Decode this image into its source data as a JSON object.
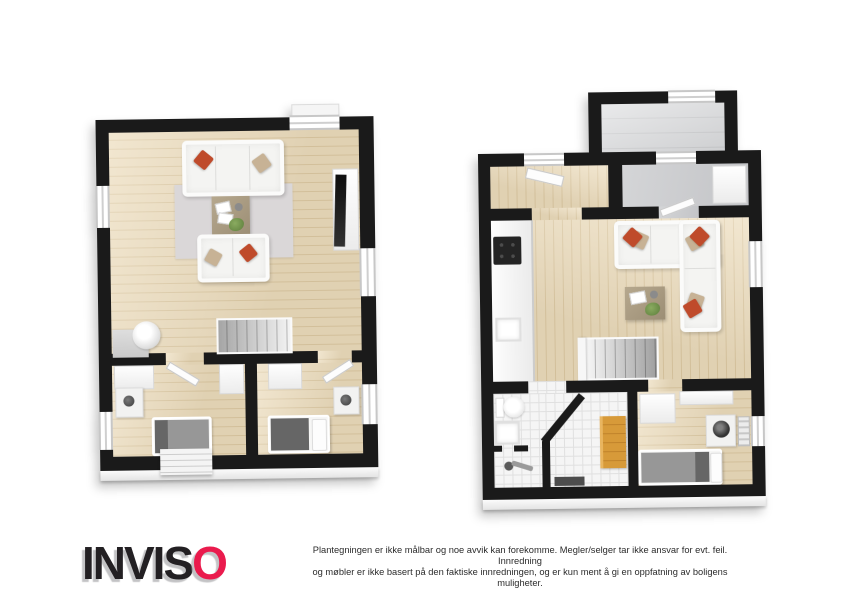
{
  "footer": {
    "brand": {
      "name": "INVISO",
      "black_part": "INVIS",
      "accent_part": "O"
    },
    "disclaimer": {
      "line1": "Plantegningen er ikke målbar og noe avvik kan forekomme. Megler/selger tar ikke ansvar for evt. feil. Innredning",
      "line2": "og møbler er ikke basert på den faktiske innredningen, og er kun ment å gi en oppfatning av boligens muligheter."
    }
  },
  "plans": {
    "left": {
      "name": "upper-floor-plan",
      "rooms": [
        "living-room",
        "bedroom-left",
        "bedroom-right",
        "staircase"
      ],
      "furniture": [
        "sofa-3-seat",
        "sofa-2-seat",
        "coffee-table",
        "rug",
        "tv-bench",
        "tv",
        "water-heater",
        "bed",
        "nightstand-lamp",
        "wardrobe",
        "stairs",
        "entry-steps"
      ]
    },
    "right": {
      "name": "main-floor-plan",
      "rooms": [
        "balcony",
        "entrance-hall",
        "hall-room",
        "kitchen",
        "living-room",
        "bathroom",
        "sauna",
        "bedroom",
        "staircase"
      ],
      "furniture": [
        "corner-sofa",
        "coffee-table",
        "kitchen-counter",
        "cooktop",
        "kitchen-sink",
        "toilet",
        "bathroom-sink",
        "shower",
        "sauna-bench",
        "bed",
        "washing-machine",
        "wardrobe",
        "radiator",
        "stairs"
      ]
    }
  },
  "colors": {
    "brand_red": "#ea1b4d",
    "text_dark": "#232023",
    "wall_black": "#1a1a1a",
    "wood_floor": "#ecdcbc",
    "wood_plank_line": "#ddc9a2",
    "tile_floor": "#f5f5f5",
    "tile_line": "#e0e0e0",
    "rug_gray": "#dad7d8",
    "sofa_white": "#f4f4f2",
    "pillow_red": "#bf4b2b",
    "pillow_tan": "#c7b295",
    "table_brown": "#ab9d84",
    "sauna_bench_orange": "#d79a39",
    "bed_gray": "#979797",
    "bed_dark_gray": "#666666",
    "appliance_dark": "#242424"
  }
}
